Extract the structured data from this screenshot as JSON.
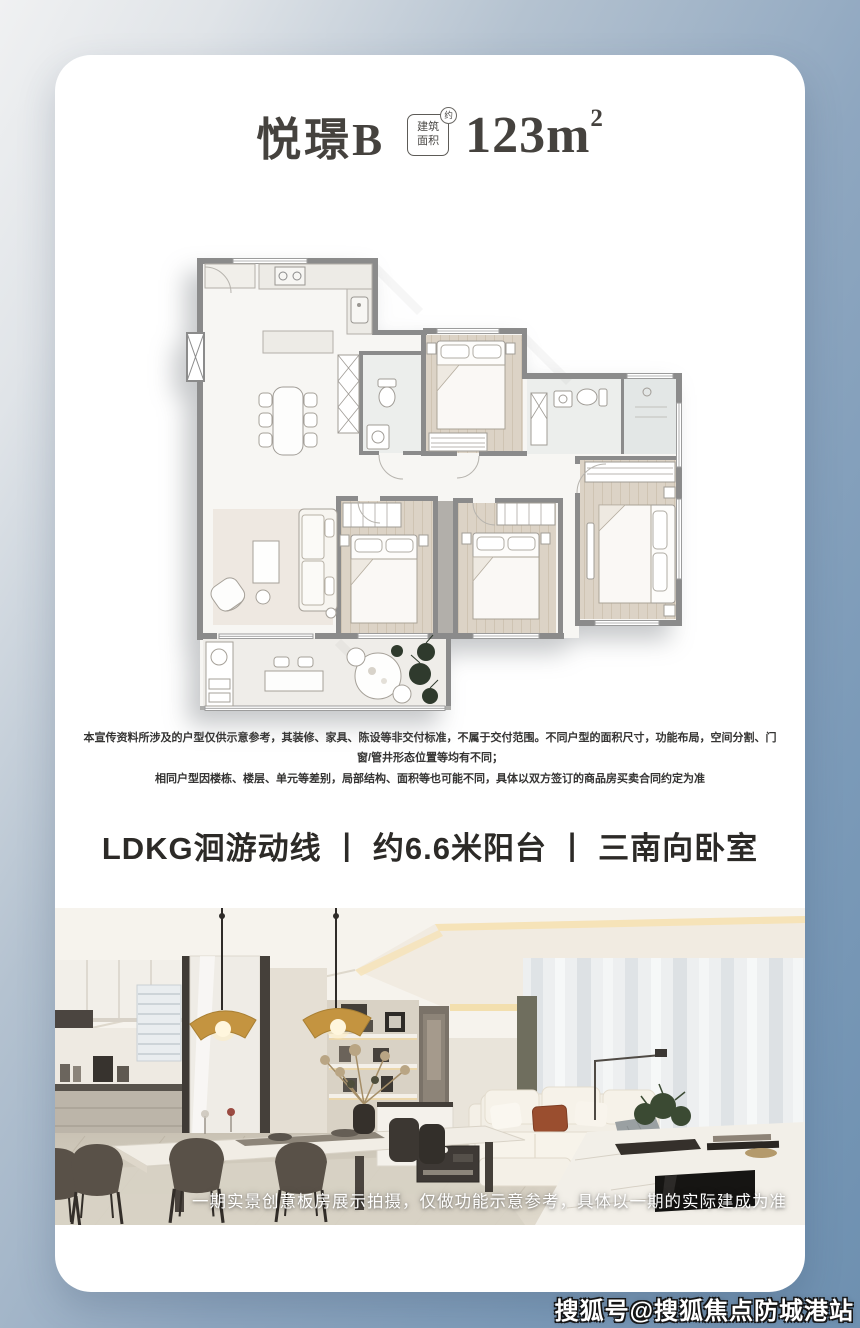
{
  "header": {
    "title": "悦璟B",
    "area_badge": {
      "line1": "建筑",
      "line2": "面积",
      "mark": "约"
    },
    "area_value": "123m",
    "area_superscript": "2"
  },
  "disclaimer": {
    "line1": "本宣传资料所涉及的户型仅供示意参考，其装修、家具、陈设等非交付标准，不属于交付范围。不同户型的面积尺寸，功能布局，空间分割、门窗/管井形态位置等均有不同；",
    "line2": "相同户型因楼栋、楼层、单元等差别，局部结构、面积等也可能不同，具体以双方签订的商品房买卖合同约定为准"
  },
  "features": {
    "text": "LDKG洄游动线 丨 约6.6米阳台 丨 三南向卧室"
  },
  "photo": {
    "caption": "一期实景创意板房展示拍摄，仅做功能示意参考，具体以一期的实际建成为准"
  },
  "watermark": {
    "text": "搜狐号@搜狐焦点防城港站"
  },
  "colors": {
    "background_blue": "#7b9ab8",
    "card": "#ffffff",
    "title_text": "#45423e",
    "feature_text": "#2c2a27",
    "plan_wall": "#8b8b8b",
    "lamp_gold": "#c49440",
    "caption_text": "#ffffff"
  }
}
